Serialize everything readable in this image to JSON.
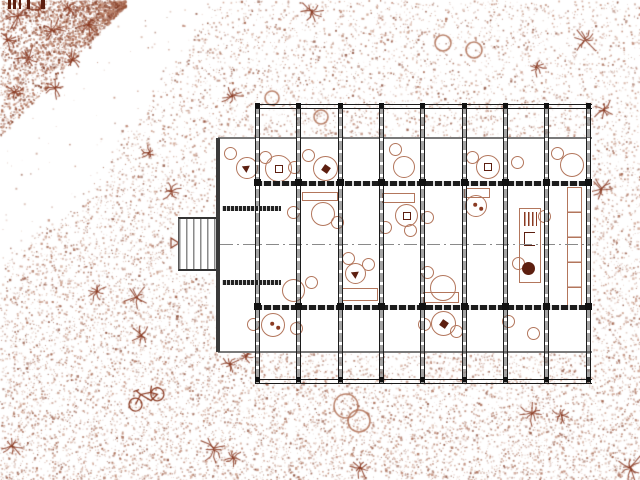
{
  "meta": {
    "drawing_type": "architectural site / floor plan",
    "visible_text": ""
  },
  "colors": {
    "wall_dark": "#1c1c1c",
    "wall_mid": "#3a3a3a",
    "facade_gray": "#7a7a7a",
    "furniture": "#b3765c",
    "furniture_dark": "#8a3a22",
    "glyph_dark": "#5d1f10",
    "tree": "#8a3a22",
    "stipple_palette": [
      "#9a563c",
      "#b0715a",
      "#7e3a24",
      "#c08a72"
    ]
  },
  "building": {
    "interior": {
      "x": 218,
      "y": 138,
      "w": 374,
      "h": 214
    },
    "bays": {
      "x_positions": [
        257,
        298,
        340,
        381,
        422,
        464,
        505,
        546,
        588
      ],
      "top_y": 105,
      "bottom_y": 383,
      "facade_n": 138,
      "wall_n": 181,
      "wall_s": 305,
      "facade_s": 351,
      "centerline_y": 244,
      "end_wall_x1": 255,
      "end_wall_x2": 592
    },
    "west_wall": {
      "x": 216,
      "y": 138,
      "w": 4,
      "h": 214
    },
    "porch": {
      "x": 178,
      "y": 217,
      "w": 40,
      "h": 54
    },
    "vestibule_bars": [
      {
        "x": 222,
        "y": 206,
        "w": 59,
        "h": 5
      },
      {
        "x": 222,
        "y": 280,
        "w": 59,
        "h": 5
      }
    ],
    "junction_rows": [
      {
        "y": 103,
        "s": 5
      },
      {
        "y": 179,
        "s": 7
      },
      {
        "y": 303,
        "s": 7
      },
      {
        "y": 377,
        "s": 5
      }
    ]
  },
  "furniture": {
    "chairs": [
      [
        224,
        147
      ],
      [
        259,
        151
      ],
      [
        288,
        161
      ],
      [
        302,
        149
      ],
      [
        389,
        143
      ],
      [
        466,
        151
      ],
      [
        511,
        156
      ],
      [
        551,
        147
      ],
      [
        247,
        318
      ],
      [
        290,
        322
      ],
      [
        418,
        318
      ],
      [
        450,
        325
      ],
      [
        502,
        315
      ],
      [
        527,
        327
      ],
      [
        287,
        206
      ],
      [
        331,
        216
      ],
      [
        379,
        221
      ],
      [
        404,
        224
      ],
      [
        421,
        211
      ],
      [
        538,
        210
      ],
      [
        305,
        276
      ],
      [
        342,
        252
      ],
      [
        362,
        258
      ],
      [
        421,
        266
      ],
      [
        512,
        257
      ]
    ],
    "round_tables": [
      [
        236,
        157,
        22,
        "bird"
      ],
      [
        265,
        155,
        27,
        "square"
      ],
      [
        313,
        156,
        25,
        "mark"
      ],
      [
        393,
        156,
        22,
        ""
      ],
      [
        476,
        155,
        24,
        "square"
      ],
      [
        560,
        153,
        24,
        ""
      ],
      [
        261,
        313,
        24,
        "dots"
      ],
      [
        431,
        311,
        25,
        "mark"
      ],
      [
        311,
        202,
        24,
        ""
      ],
      [
        395,
        204,
        23,
        "square"
      ],
      [
        465,
        195,
        22,
        "dots"
      ],
      [
        345,
        263,
        21,
        "bird"
      ],
      [
        430,
        275,
        26,
        ""
      ],
      [
        282,
        279,
        23,
        ""
      ]
    ],
    "rect_tables": [
      [
        302,
        192,
        36,
        9
      ],
      [
        382,
        193,
        33,
        10
      ],
      [
        464,
        188,
        26,
        10
      ],
      [
        342,
        288,
        36,
        13
      ],
      [
        423,
        292,
        36,
        11
      ]
    ],
    "cabinet": {
      "x": 519,
      "y": 208,
      "w": 22,
      "h": 75
    },
    "stove": {
      "x": 522,
      "y": 262,
      "d": 13
    },
    "shelf_column": {
      "x": 567,
      "y": 187,
      "w": 15,
      "h": 123,
      "segment": 25
    }
  },
  "landscape": {
    "spiky_trees": [
      [
        312,
        12,
        13
      ],
      [
        585,
        40,
        15
      ],
      [
        537,
        67,
        10
      ],
      [
        604,
        110,
        12
      ],
      [
        601,
        189,
        13
      ],
      [
        171,
        192,
        11
      ],
      [
        149,
        153,
        9
      ],
      [
        232,
        96,
        11
      ],
      [
        97,
        292,
        10
      ],
      [
        137,
        297,
        13
      ],
      [
        141,
        335,
        10
      ],
      [
        246,
        356,
        8
      ],
      [
        230,
        364,
        9
      ],
      [
        214,
        449,
        15
      ],
      [
        233,
        458,
        11
      ],
      [
        360,
        468,
        11
      ],
      [
        532,
        413,
        14
      ],
      [
        561,
        415,
        10
      ],
      [
        630,
        468,
        15
      ],
      [
        12,
        446,
        12
      ]
    ],
    "corner_trees": [
      [
        18,
        16,
        15
      ],
      [
        52,
        30,
        13
      ],
      [
        28,
        58,
        13
      ],
      [
        72,
        60,
        12
      ],
      [
        55,
        88,
        11
      ],
      [
        15,
        92,
        11
      ],
      [
        88,
        25,
        11
      ],
      [
        40,
        8,
        10
      ],
      [
        8,
        40,
        10
      ],
      [
        68,
        8,
        9
      ]
    ],
    "circle_trees": [
      [
        443,
        43,
        8
      ],
      [
        474,
        50,
        8
      ],
      [
        346,
        406,
        12
      ],
      [
        359,
        421,
        11
      ],
      [
        272,
        98,
        7
      ],
      [
        321,
        117,
        7
      ]
    ],
    "bicycle": {
      "x": 146,
      "y": 398,
      "rot": -18
    },
    "triangle_marker": {
      "x": 171,
      "y": 238
    },
    "scale_bar": {
      "y": 0,
      "h": 9,
      "bars": [
        [
          8,
          3
        ],
        [
          13,
          3
        ],
        [
          19,
          2
        ],
        [
          27,
          3
        ],
        [
          41,
          4
        ]
      ]
    }
  },
  "stipple": {
    "seed": 42,
    "count": 26000,
    "coarse_count": 2600,
    "corner_count": 2600,
    "boundary": [
      [
        0,
        222
      ],
      [
        100,
        152
      ],
      [
        200,
        88
      ],
      [
        262,
        0
      ]
    ]
  }
}
